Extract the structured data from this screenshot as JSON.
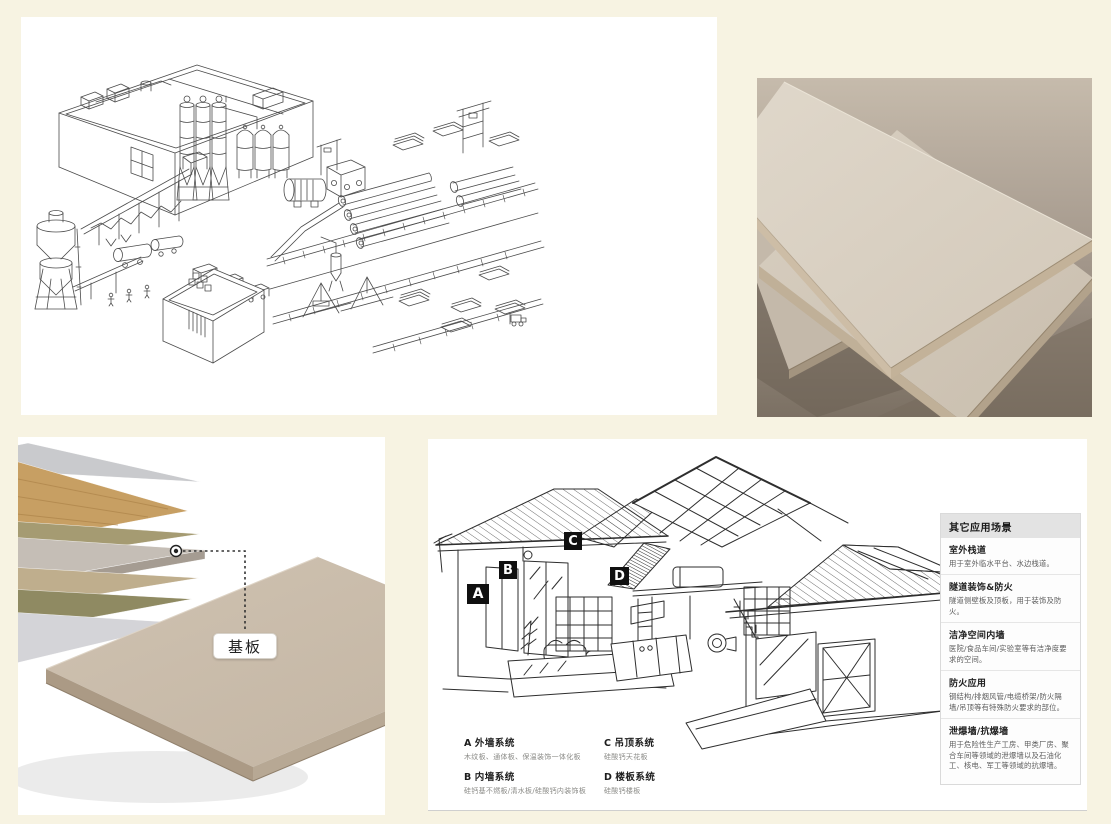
{
  "colors": {
    "page_bg": "#f7f3e2",
    "marker_bg": "#101010",
    "marker_text": "#ffffff",
    "sidebar_header_bg": "#e3e3e3",
    "board_beige": "#d6cdc0",
    "wood_layer": "#c79f63",
    "base_board_gray": "#c5beb6"
  },
  "layers": {
    "callout_label": "基板"
  },
  "house": {
    "markers": [
      {
        "letter": "A"
      },
      {
        "letter": "B"
      },
      {
        "letter": "C"
      },
      {
        "letter": "D"
      }
    ],
    "legend": [
      {
        "key": "A",
        "title": "外墙系统",
        "desc": "木纹板、通体板、保温装饰一体化板"
      },
      {
        "key": "B",
        "title": "内墙系统",
        "desc": "硅钙基不燃板/清水板/硅酸钙内装饰板"
      },
      {
        "key": "C",
        "title": "吊顶系统",
        "desc": "硅酸钙天花板"
      },
      {
        "key": "D",
        "title": "楼板系统",
        "desc": "硅酸钙楼板"
      }
    ],
    "sidebar": {
      "title": "其它应用场景",
      "sections": [
        {
          "title": "室外栈道",
          "desc": "用于室外临水平台、水边栈道。"
        },
        {
          "title": "隧道装饰&防火",
          "desc": "隧道侧壁板及顶板，用于装饰及防火。"
        },
        {
          "title": "洁净空间内墙",
          "desc": "医院/食品车间/实验室等有洁净度要求的空间。"
        },
        {
          "title": "防火应用",
          "desc": "钢结构/排烟风管/电缆桥架/防火隔墙/吊顶等有特殊防火要求的部位。"
        },
        {
          "title": "泄爆墙/抗爆墙",
          "desc": "用于危险性生产工房、甲类厂房、聚合车间等领域的泄爆墙以及石油化工、核电、军工等领域的抗爆墙。"
        }
      ]
    }
  }
}
